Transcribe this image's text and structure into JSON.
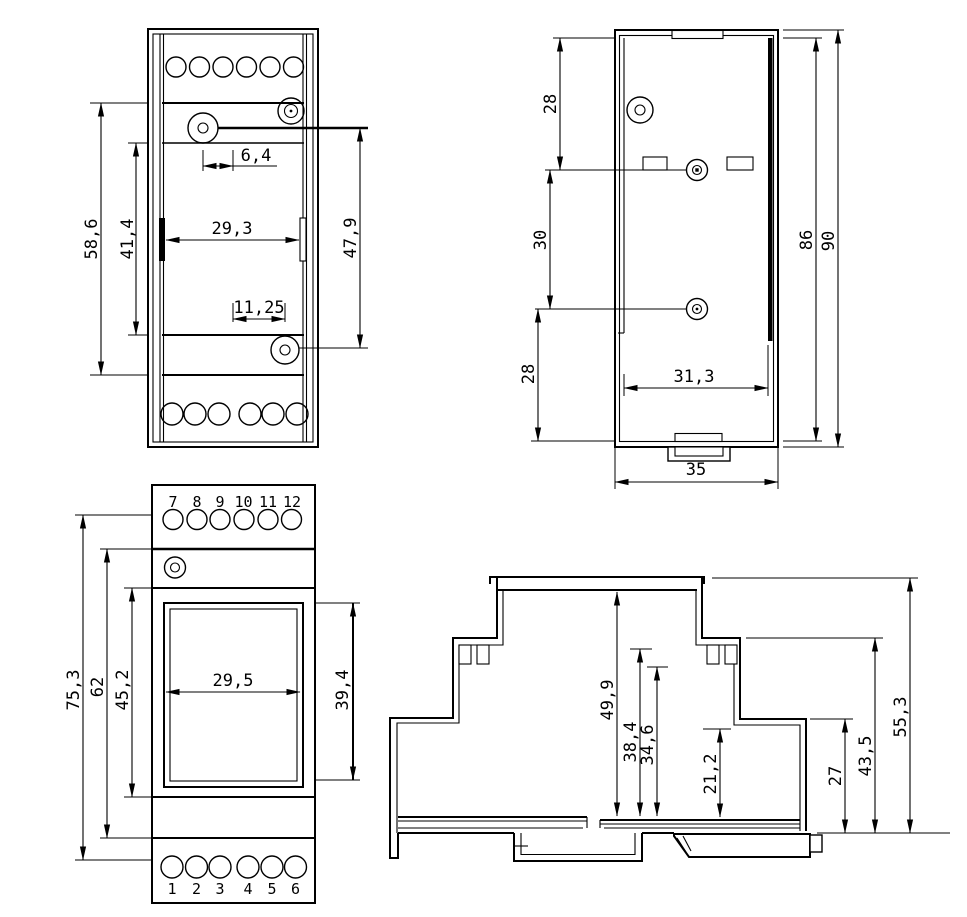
{
  "drawing": {
    "kind": "technical-dimension-drawing",
    "views": {
      "front_top": {
        "dims": {
          "h586": "58,6",
          "h414": "41,4",
          "w64": "6,4",
          "w293": "29,3",
          "w1125": "11,25",
          "h479": "47,9"
        }
      },
      "rear": {
        "dims": {
          "t28": "28",
          "m30": "30",
          "b28": "28",
          "h86": "86",
          "h90": "90",
          "w313": "31,3",
          "w35": "35"
        }
      },
      "front_bottom": {
        "terminals_top": [
          "7",
          "8",
          "9",
          "10",
          "11",
          "12"
        ],
        "terminals_bottom": [
          "1",
          "2",
          "3",
          "4",
          "5",
          "6"
        ],
        "dims": {
          "h753": "75,3",
          "h62": "62",
          "h452": "45,2",
          "w295": "29,5",
          "h394": "39,4"
        }
      },
      "side": {
        "dims": {
          "h499": "49,9",
          "h384": "38,4",
          "h346": "34,6",
          "h212": "21,2",
          "h27": "27",
          "h435": "43,5",
          "h553": "55,3"
        }
      }
    }
  }
}
